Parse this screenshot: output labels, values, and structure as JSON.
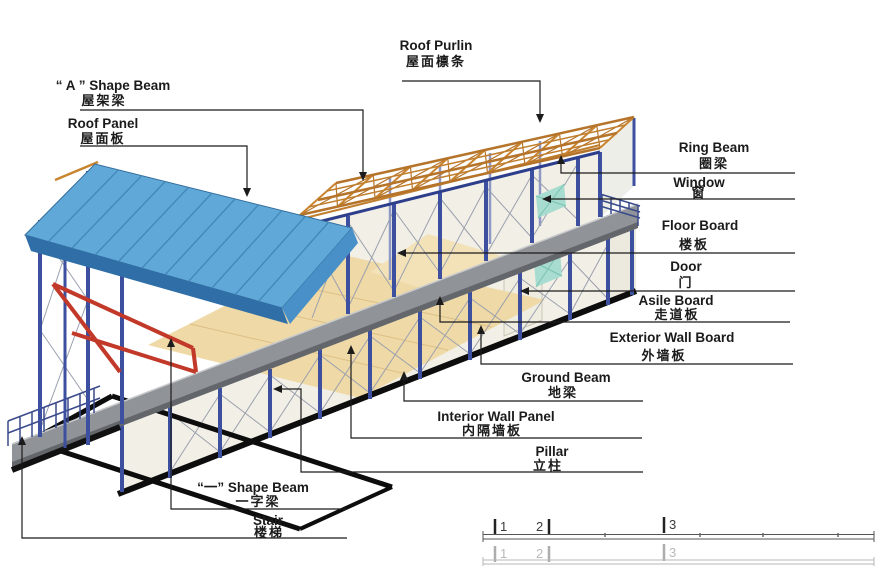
{
  "figure": {
    "kind": "prefab-house-construction-diagram",
    "language": "English + Chinese"
  },
  "labels": {
    "a_shape_beam": {
      "en": "“ A ” Shape Beam",
      "zh": "屋架梁"
    },
    "roof_panel": {
      "en": "Roof Panel",
      "zh": "屋面板"
    },
    "roof_purlin": {
      "en": "Roof Purlin",
      "zh": "屋面檩条"
    },
    "ring_beam": {
      "en": "Ring Beam",
      "zh": "圈梁"
    },
    "window": {
      "en": "Window",
      "zh": "窗"
    },
    "floor_board": {
      "en": "Floor Board",
      "zh": "楼板"
    },
    "door": {
      "en": "Door",
      "zh": "门"
    },
    "asile_board": {
      "en": "Asile Board",
      "zh": "走道板"
    },
    "exterior_wall_board": {
      "en": "Exterior Wall Board",
      "zh": "外墙板"
    },
    "ground_beam": {
      "en": "Ground Beam",
      "zh": "地梁"
    },
    "interior_wall_panel": {
      "en": "Interior Wall Panel",
      "zh": "内隔墙板"
    },
    "pillar": {
      "en": "Pillar",
      "zh": "立柱"
    },
    "one_shape_beam": {
      "en": "“一” Shape Beam",
      "zh": "一字梁"
    },
    "stair": {
      "en": "Stair",
      "zh": "楼梯"
    }
  },
  "ruler": {
    "marks": [
      "1",
      "2",
      "3"
    ]
  },
  "colors": {
    "roof_panel_blue": "#5fa8d8",
    "roof_fascia_blue": "#2f6ea6",
    "purlin_orange": "#c07f2e",
    "pillar_blue": "#3d4f9f",
    "walkway_gray": "#909398",
    "ground_beam_black": "#0d0d0d",
    "one_beam_red": "#c2392a",
    "window_teal": "#a8dcd0",
    "wall_cream": "#f2efe6",
    "floor_wood": "#efd9a6"
  }
}
